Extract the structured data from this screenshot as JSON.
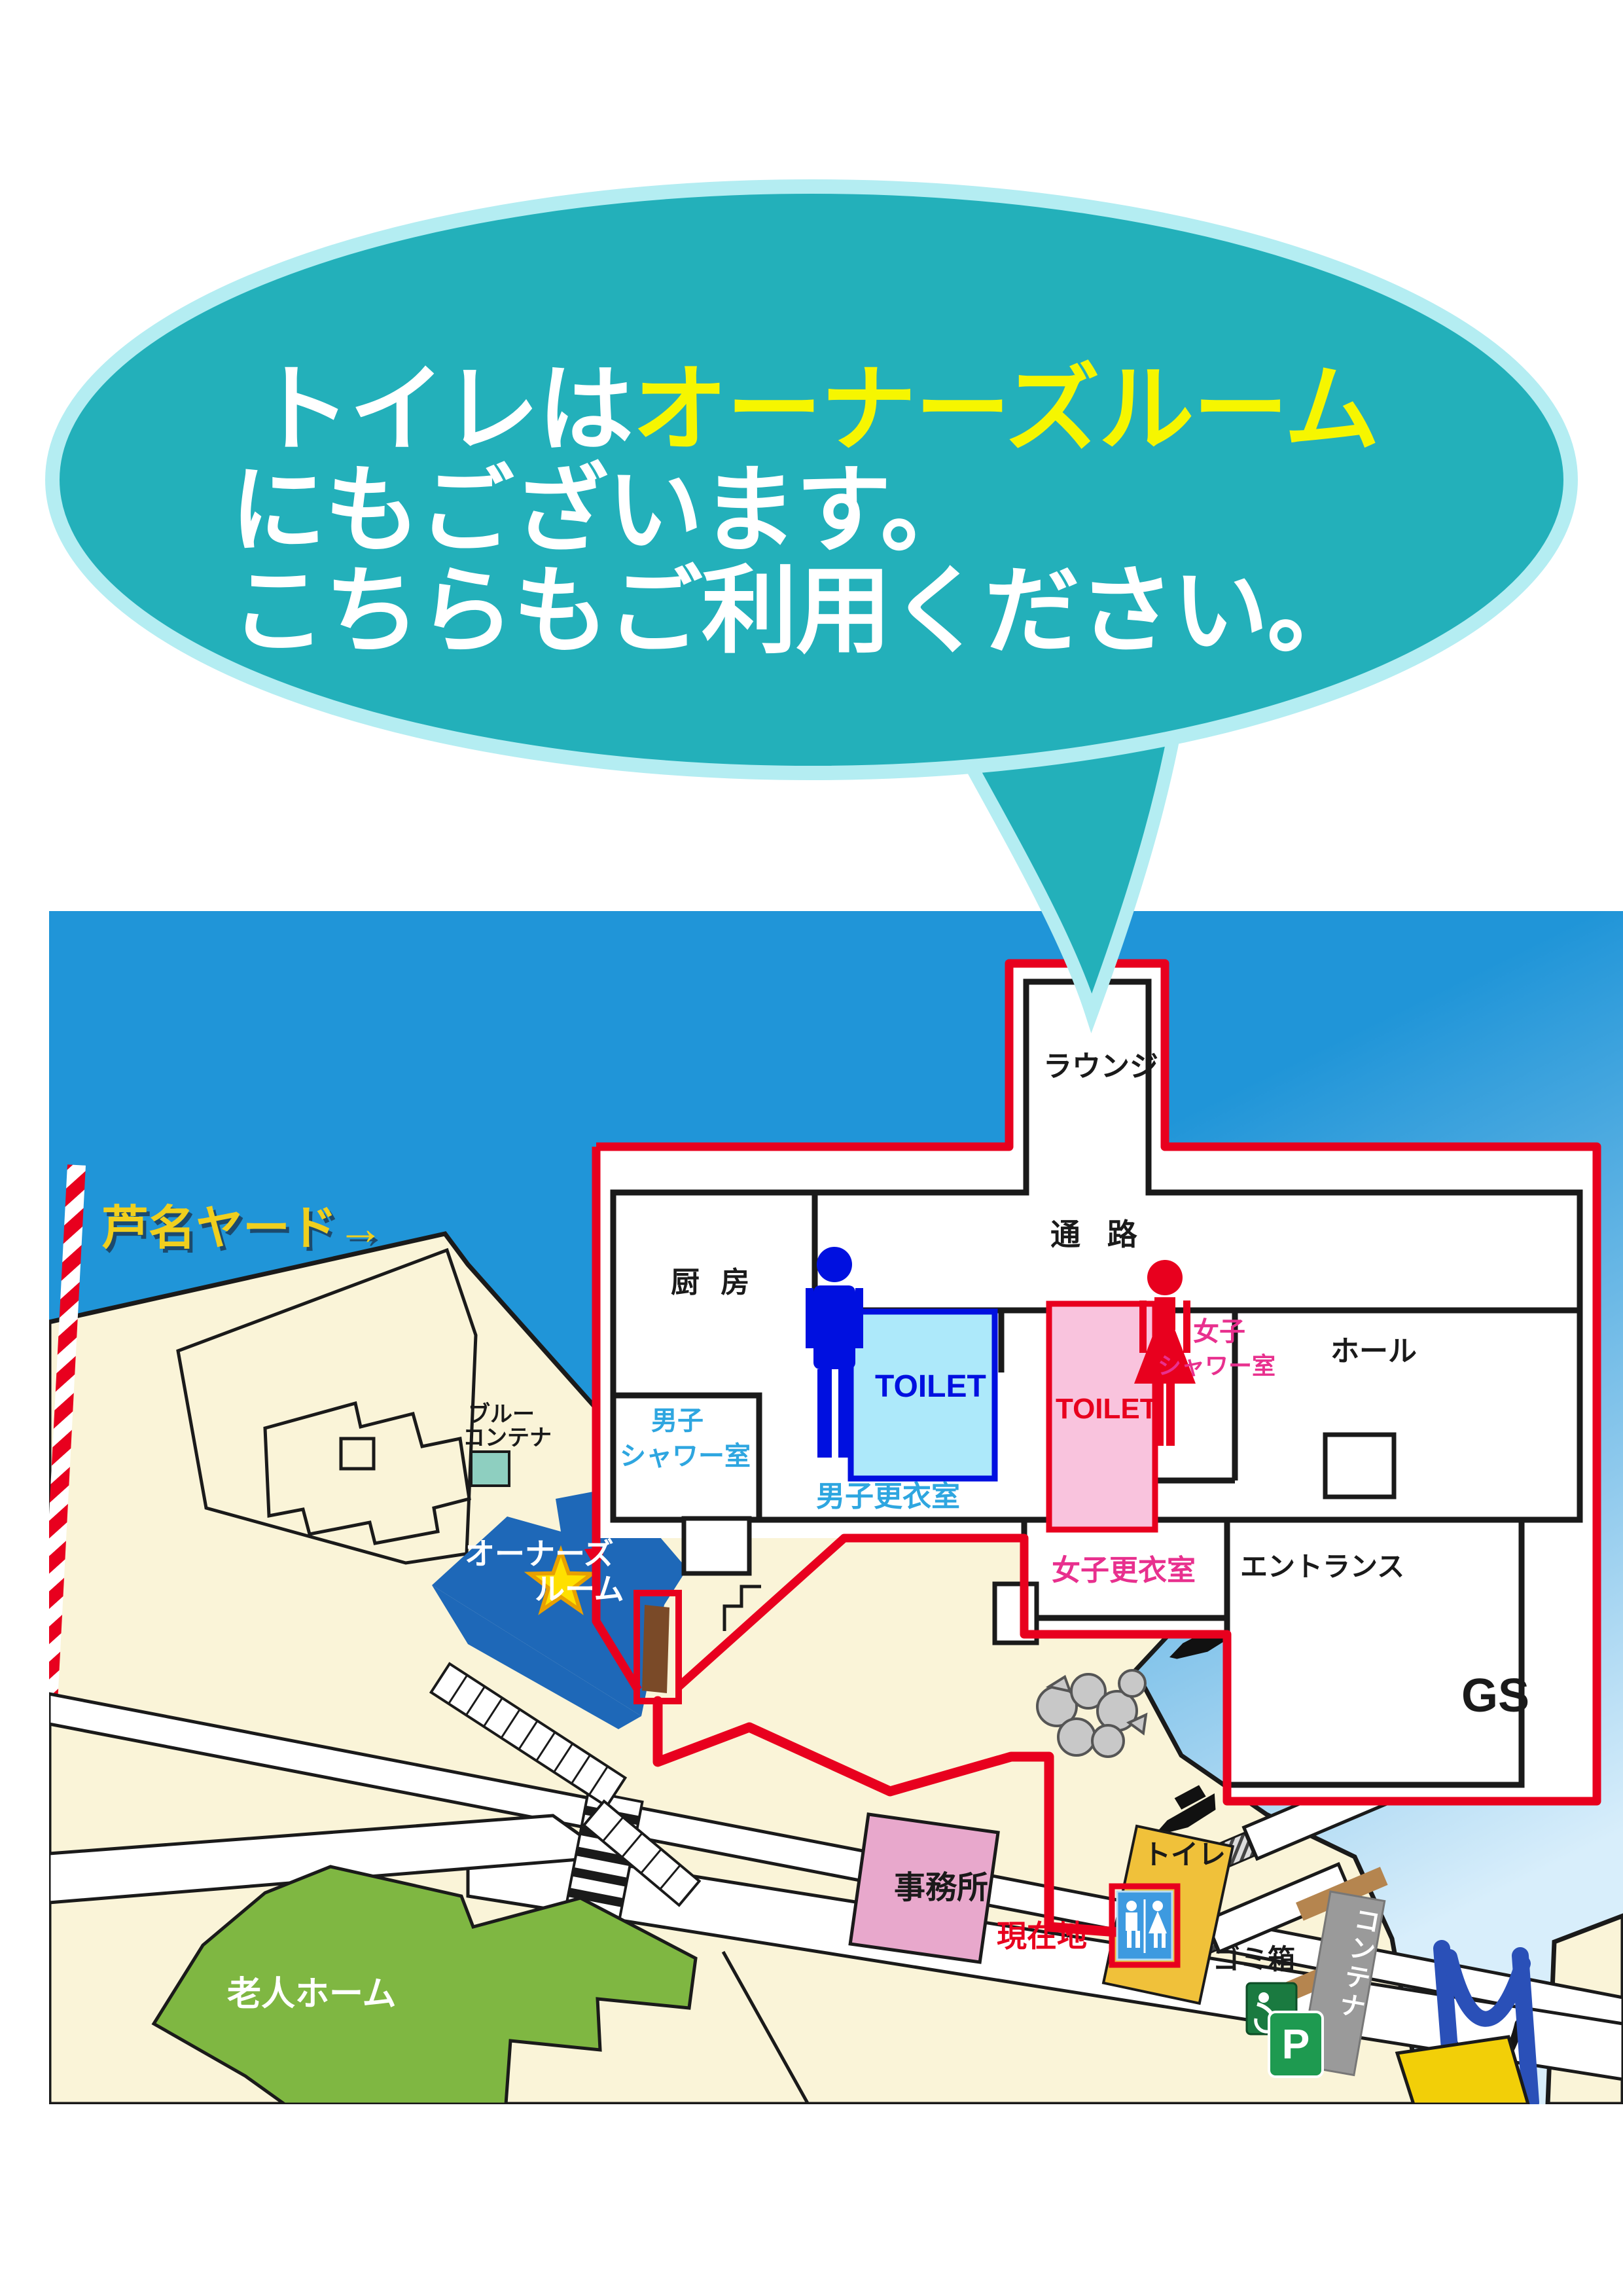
{
  "bubble": {
    "line1_white": "トイレは",
    "line1_yellow": "オーナーズルーム",
    "line2": "にもございます。",
    "line3": "こちらもご利用ください。"
  },
  "floor_plan": {
    "lounge": "ラウンジ",
    "corridor": "通 路",
    "kitchen": "厨 房",
    "mens_shower_line1": "男子",
    "mens_shower_line2": "シャワー室",
    "mens_toilet": "TOILET",
    "womens_toilet": "TOILET",
    "womens_shower_line1": "女子",
    "womens_shower_line2": "シャワー室",
    "mens_locker": "男子更衣室",
    "womens_locker": "女子更衣室",
    "hall": "ホール",
    "entrance": "エントランス"
  },
  "map": {
    "yard": "芦名ヤード→",
    "blue_container_line1": "ブルー",
    "blue_container_line2": "コンテナ",
    "owners_room_line1": "オーナーズ",
    "owners_room_line2": "ルーム",
    "office": "事務所",
    "toilet": "トイレ",
    "current_location": "現在地",
    "trash": "ゴミ箱",
    "container": "コンテナ",
    "slope": "坂",
    "gs": "GS",
    "parking": "P",
    "nursing_home": "老人ホーム"
  },
  "colors": {
    "bubble_fill": "#23b0ba",
    "bubble_border": "#b4edf2",
    "highlight_yellow": "#f6f600",
    "sea": "#2095d8",
    "sea_light": "#d8eefb",
    "land": "#faf4d8",
    "outline": "#1a1a1a",
    "route_red": "#e8001e",
    "owners_blue": "#1e68b8",
    "star_yellow": "#ffe000",
    "mens_blue": "#0010e0",
    "mens_lightblue_fill": "#ade9fa",
    "womens_red": "#e8001e",
    "womens_pink_fill": "#f9c3dd",
    "pink_text": "#e8308e",
    "locker_text_blue": "#2ea6e0",
    "nursing_green": "#7fb742",
    "office_pink": "#e8a8cc",
    "toilet_building_yellow": "#f0c13a",
    "sign_blue": "#3d9ae0",
    "container_gray": "#9a9a9a",
    "slope_darkred": "#9e2c3c",
    "pier_orange": "#e8891a",
    "m_structure_blue": "#2a50b8",
    "parking_green": "#1e9a50",
    "trash_green": "#1a7a40",
    "blue_container_teal": "#8ecfc0",
    "door_brown": "#7a4a28",
    "ramp_tan": "#b5854f"
  }
}
